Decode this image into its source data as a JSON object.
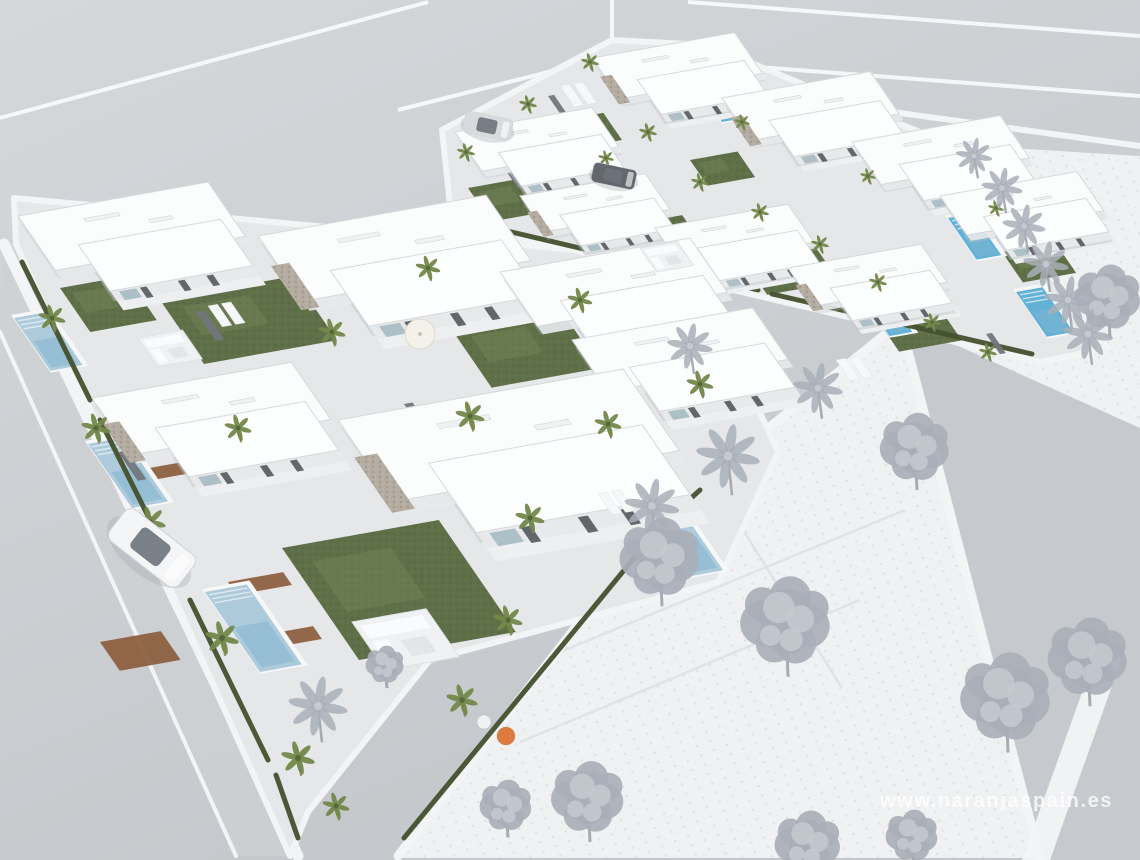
{
  "scene": {
    "width": 1140,
    "height": 860
  },
  "watermark": {
    "text": "www.naranjaspain.es"
  },
  "colors": {
    "bgTop": "#d5d8db",
    "bgBottom": "#c3c6ca",
    "line": "#f8f9fa",
    "curb": "#f3f4f5",
    "field": "#eff1f2",
    "fieldDot": "#dcdfe2",
    "fieldDot2": "#e6e8ea",
    "plotLine": "#dfe2e4",
    "road2": "#c6c9cd",
    "park": "#ced1d4",
    "blockPave": "#e5e7e9",
    "house": "#fbfcfc",
    "houseB": "#fdfefe",
    "houseSide": "#e7e9eb",
    "houseShadow": "#c2c5c9",
    "parapet": "#d6d9db",
    "stone": "#b4aca0",
    "stoneDot": "#9c9488",
    "stoneDot2": "#c4bcae",
    "lawn": "#5f7048",
    "lawnLight": "#78885c",
    "lawnDot": "#3f4c2e",
    "hedge": "#44512f",
    "pool": "#aecbdb",
    "poolDeep": "#83b5cf",
    "poolBright": "#62b1d7",
    "coping": "#f5f7f8",
    "palmLeaf": "#73884a",
    "palmDark": "#55683a",
    "trunk": "#8d7c5f",
    "gray1": "#a9afb8",
    "gray2": "#c5cad0",
    "grayTrunk": "#979ba3",
    "gate": "#72767c",
    "glass": "#6d737b",
    "windowDark": "#4a5056",
    "glaze": "#a2b7c1",
    "planter": "#8a5a38",
    "furn": "#eff1f2",
    "furnEdge": "#dfe2e5",
    "vent": "#f0f2f3",
    "ventEdge": "#d2d5d8",
    "carShadow": "#9aa0a6",
    "watermark": "rgba(255,255,255,0.78)"
  },
  "iso": {
    "ax": 0.95,
    "ay": -0.17,
    "bx": 0.55,
    "by": 0.8
  },
  "roads": {
    "markings": [
      [
        0,
        118,
        428,
        2
      ],
      [
        398,
        110,
        612,
        56
      ],
      [
        612,
        0,
        612,
        56
      ],
      [
        612,
        56,
        1140,
        96
      ],
      [
        688,
        2,
        1140,
        36
      ]
    ],
    "parkStrip": [
      [
        4,
        244
      ],
      [
        298,
        856
      ],
      [
        236,
        856
      ],
      [
        0,
        332
      ]
    ],
    "r2": [
      [
        898,
        318
      ],
      [
        1140,
        430
      ],
      [
        1140,
        860
      ],
      [
        1040,
        860
      ]
    ],
    "crossing": [
      [
        1098,
        648
      ],
      [
        1122,
        658
      ],
      [
        1050,
        860
      ],
      [
        1022,
        860
      ]
    ],
    "curbs": [
      {
        "pts": [
          [
            4,
            244
          ],
          [
            298,
            856
          ]
        ],
        "w": 11
      },
      {
        "pts": [
          [
            0,
            332
          ],
          [
            236,
            856
          ]
        ],
        "w": 4
      },
      {
        "pts": [
          [
            398,
            856
          ],
          [
            648,
            534
          ],
          [
            706,
            478
          ],
          [
            898,
            324
          ]
        ],
        "w": 9
      },
      {
        "pts": [
          [
            446,
            222
          ],
          [
            1038,
            360
          ]
        ],
        "w": 7
      },
      {
        "pts": [
          [
            762,
            94
          ],
          [
            1140,
            146
          ]
        ],
        "w": 6
      },
      {
        "pts": [
          [
            448,
            126
          ],
          [
            614,
            44
          ]
        ],
        "w": 5
      },
      {
        "pts": [
          [
            710,
            46
          ],
          [
            946,
            142
          ]
        ],
        "w": 5
      },
      {
        "pts": [
          [
            948,
            146
          ],
          [
            902,
            318
          ]
        ],
        "w": 7
      },
      {
        "pts": [
          [
            900,
            320
          ],
          [
            1040,
            858
          ]
        ],
        "w": 9
      }
    ]
  },
  "fields": {
    "f1": [
      [
        398,
        858
      ],
      [
        646,
        536
      ],
      [
        706,
        478
      ],
      [
        900,
        322
      ],
      [
        1040,
        858
      ]
    ],
    "f2": [
      [
        946,
        144
      ],
      [
        1140,
        156
      ],
      [
        1140,
        428
      ],
      [
        900,
        320
      ]
    ],
    "plotLines": [
      [
        560,
        652,
        905,
        510
      ],
      [
        708,
        474,
        842,
        688
      ],
      [
        520,
        742,
        860,
        600
      ]
    ]
  },
  "blocks": {
    "lower": [
      [
        14,
        198
      ],
      [
        575,
        250
      ],
      [
        708,
        298
      ],
      [
        778,
        452
      ],
      [
        718,
        582
      ],
      [
        430,
        660
      ],
      [
        308,
        812
      ],
      [
        290,
        856
      ],
      [
        16,
        244
      ]
    ],
    "upper": [
      [
        442,
        130
      ],
      [
        612,
        40
      ],
      [
        708,
        45
      ],
      [
        950,
        145
      ],
      [
        1108,
        348
      ],
      [
        1040,
        362
      ],
      [
        452,
        224
      ]
    ]
  },
  "houses": [
    {
      "x": 455,
      "y": 132,
      "s": 0.72,
      "stone": false
    },
    {
      "x": 592,
      "y": 58,
      "s": 0.75,
      "stone": true
    },
    {
      "x": 722,
      "y": 98,
      "s": 0.78,
      "stone": true
    },
    {
      "x": 852,
      "y": 142,
      "s": 0.78,
      "stone": false
    },
    {
      "x": 940,
      "y": 196,
      "s": 0.72,
      "stone": false
    },
    {
      "x": 520,
      "y": 196,
      "s": 0.66,
      "stone": true
    },
    {
      "x": 655,
      "y": 228,
      "s": 0.7,
      "stone": false
    },
    {
      "x": 788,
      "y": 268,
      "s": 0.7,
      "stone": true
    },
    {
      "x": 18,
      "y": 216,
      "s": 1.0,
      "stone": false
    },
    {
      "x": 258,
      "y": 236,
      "s": 1.2,
      "stone": true
    },
    {
      "x": 500,
      "y": 272,
      "s": 1.0,
      "stone": false
    },
    {
      "x": 92,
      "y": 398,
      "s": 1.05,
      "stone": true
    },
    {
      "x": 338,
      "y": 420,
      "s": 1.5,
      "stone": true
    },
    {
      "x": 572,
      "y": 340,
      "s": 0.95,
      "stone": false
    }
  ],
  "pools": [
    {
      "x": 14,
      "y": 318,
      "w": 34,
      "h": 66,
      "bright": false
    },
    {
      "x": 88,
      "y": 444,
      "w": 38,
      "h": 80,
      "bright": false
    },
    {
      "x": 205,
      "y": 592,
      "w": 44,
      "h": 100,
      "bright": false
    },
    {
      "x": 585,
      "y": 428,
      "w": 36,
      "h": 82,
      "bright": false
    },
    {
      "x": 646,
      "y": 514,
      "w": 36,
      "h": 78,
      "bright": false
    },
    {
      "x": 948,
      "y": 218,
      "w": 26,
      "h": 52,
      "bright": true
    },
    {
      "x": 1016,
      "y": 292,
      "w": 28,
      "h": 56,
      "bright": true
    },
    {
      "x": 862,
      "y": 296,
      "w": 24,
      "h": 50,
      "bright": true
    },
    {
      "x": 700,
      "y": 90,
      "w": 20,
      "h": 40,
      "bright": true
    }
  ],
  "lawns": [
    {
      "x": 160,
      "y": 300,
      "w": 140,
      "h": 80
    },
    {
      "x": 60,
      "y": 288,
      "w": 70,
      "h": 55
    },
    {
      "x": 282,
      "y": 548,
      "w": 165,
      "h": 140
    },
    {
      "x": 452,
      "y": 330,
      "w": 115,
      "h": 72
    },
    {
      "x": 540,
      "y": 468,
      "w": 115,
      "h": 80
    },
    {
      "x": 600,
      "y": 252,
      "w": 80,
      "h": 50
    },
    {
      "x": 468,
      "y": 188,
      "w": 66,
      "h": 42
    },
    {
      "x": 610,
      "y": 228,
      "w": 76,
      "h": 46
    },
    {
      "x": 742,
      "y": 258,
      "w": 76,
      "h": 46
    },
    {
      "x": 876,
      "y": 318,
      "w": 66,
      "h": 42
    },
    {
      "x": 1002,
      "y": 252,
      "w": 56,
      "h": 38
    },
    {
      "x": 552,
      "y": 122,
      "w": 54,
      "h": 34
    },
    {
      "x": 690,
      "y": 160,
      "w": 50,
      "h": 32
    },
    {
      "x": 956,
      "y": 128,
      "w": 44,
      "h": 28
    }
  ],
  "palms": [
    [
      52,
      318,
      12
    ],
    [
      96,
      428,
      13
    ],
    [
      150,
      522,
      14
    ],
    [
      222,
      638,
      15
    ],
    [
      298,
      758,
      15
    ],
    [
      336,
      806,
      12
    ],
    [
      238,
      428,
      12
    ],
    [
      332,
      332,
      12
    ],
    [
      470,
      416,
      13
    ],
    [
      530,
      518,
      13
    ],
    [
      608,
      424,
      12
    ],
    [
      668,
      556,
      13
    ],
    [
      428,
      268,
      11
    ],
    [
      580,
      300,
      11
    ],
    [
      700,
      384,
      12
    ],
    [
      508,
      620,
      13
    ],
    [
      462,
      700,
      14
    ],
    [
      466,
      152,
      8
    ],
    [
      528,
      104,
      8
    ],
    [
      590,
      62,
      8
    ],
    [
      648,
      132,
      8
    ],
    [
      700,
      182,
      8
    ],
    [
      760,
      212,
      8
    ],
    [
      820,
      244,
      8
    ],
    [
      878,
      282,
      8
    ],
    [
      932,
      322,
      8
    ],
    [
      988,
      352,
      8
    ],
    [
      606,
      158,
      7
    ],
    [
      742,
      122,
      7
    ],
    [
      868,
      176,
      7
    ],
    [
      996,
      208,
      7
    ]
  ],
  "hedges": [
    [
      22,
      262,
      90,
      400
    ],
    [
      100,
      420,
      180,
      580
    ],
    [
      190,
      600,
      268,
      760
    ],
    [
      276,
      775,
      298,
      838
    ],
    [
      404,
      838,
      644,
      546
    ],
    [
      658,
      528,
      700,
      490
    ],
    [
      452,
      218,
      758,
      290
    ],
    [
      772,
      294,
      1032,
      354
    ]
  ],
  "planters": [
    {
      "x": 228,
      "y": 582,
      "w": 58,
      "h": 16
    },
    {
      "x": 258,
      "y": 636,
      "w": 58,
      "h": 16
    },
    {
      "x": 138,
      "y": 470,
      "w": 48,
      "h": 14
    },
    {
      "x": 100,
      "y": 642,
      "w": 64,
      "h": 36
    }
  ],
  "gates": [
    {
      "x": 196,
      "y": 312,
      "s": 1
    },
    {
      "x": 404,
      "y": 404,
      "s": 1
    },
    {
      "x": 560,
      "y": 462,
      "s": 1
    },
    {
      "x": 118,
      "y": 452,
      "s": 1
    },
    {
      "x": 630,
      "y": 352,
      "s": 0.9
    },
    {
      "x": 504,
      "y": 168,
      "s": 0.7
    },
    {
      "x": 628,
      "y": 208,
      "s": 0.7
    },
    {
      "x": 752,
      "y": 248,
      "s": 0.7
    },
    {
      "x": 872,
      "y": 292,
      "s": 0.7
    },
    {
      "x": 986,
      "y": 334,
      "s": 0.7
    },
    {
      "x": 548,
      "y": 96,
      "s": 0.7
    },
    {
      "x": 668,
      "y": 70,
      "s": 0.7
    }
  ],
  "grayTrees": [
    {
      "t": "p",
      "x": 974,
      "y": 156,
      "r": 16
    },
    {
      "t": "p",
      "x": 1002,
      "y": 188,
      "r": 18
    },
    {
      "t": "p",
      "x": 1024,
      "y": 226,
      "r": 19
    },
    {
      "t": "p",
      "x": 1046,
      "y": 264,
      "r": 20
    },
    {
      "t": "p",
      "x": 1068,
      "y": 300,
      "r": 21
    },
    {
      "t": "r",
      "x": 1108,
      "y": 298,
      "r": 38
    },
    {
      "t": "p",
      "x": 1088,
      "y": 334,
      "r": 22
    },
    {
      "t": "p",
      "x": 690,
      "y": 346,
      "r": 20
    },
    {
      "t": "p",
      "x": 818,
      "y": 388,
      "r": 22
    },
    {
      "t": "r",
      "x": 915,
      "y": 448,
      "r": 40
    },
    {
      "t": "p",
      "x": 728,
      "y": 456,
      "r": 28
    },
    {
      "t": "p",
      "x": 652,
      "y": 506,
      "r": 24
    },
    {
      "t": "r",
      "x": 660,
      "y": 558,
      "r": 46
    },
    {
      "t": "r",
      "x": 786,
      "y": 622,
      "r": 52
    },
    {
      "t": "r",
      "x": 385,
      "y": 665,
      "r": 22
    },
    {
      "t": "r",
      "x": 1088,
      "y": 658,
      "r": 46
    },
    {
      "t": "r",
      "x": 1006,
      "y": 698,
      "r": 52
    },
    {
      "t": "p",
      "x": 318,
      "y": 706,
      "r": 26
    },
    {
      "t": "r",
      "x": 588,
      "y": 798,
      "r": 42
    },
    {
      "t": "r",
      "x": 506,
      "y": 806,
      "r": 30
    },
    {
      "t": "r",
      "x": 912,
      "y": 836,
      "r": 30
    },
    {
      "t": "r",
      "x": 808,
      "y": 844,
      "r": 38
    }
  ],
  "cars": [
    {
      "x": 152,
      "y": 548,
      "rot": 38,
      "s": 1,
      "body": "#f4f5f6"
    },
    {
      "x": 488,
      "y": 126,
      "rot": 12,
      "s": 0.55,
      "body": "#d8dbde"
    },
    {
      "x": 614,
      "y": 176,
      "rot": 12,
      "s": 0.5,
      "body": "#64686e"
    }
  ],
  "furniture": {
    "sofas": [
      {
        "x": 352,
        "y": 622,
        "s": 1
      },
      {
        "x": 138,
        "y": 338,
        "s": 0.6
      },
      {
        "x": 640,
        "y": 248,
        "s": 0.5
      }
    ],
    "loungers": [
      [
        208,
        306
      ],
      [
        598,
        494
      ],
      [
        836,
        360
      ],
      [
        560,
        86
      ]
    ],
    "parasols": [
      [
        420,
        334
      ]
    ],
    "poufs": [
      [
        506,
        736,
        9,
        "#df7a3e"
      ],
      [
        484,
        722,
        7,
        "#f0f1f2"
      ]
    ]
  }
}
